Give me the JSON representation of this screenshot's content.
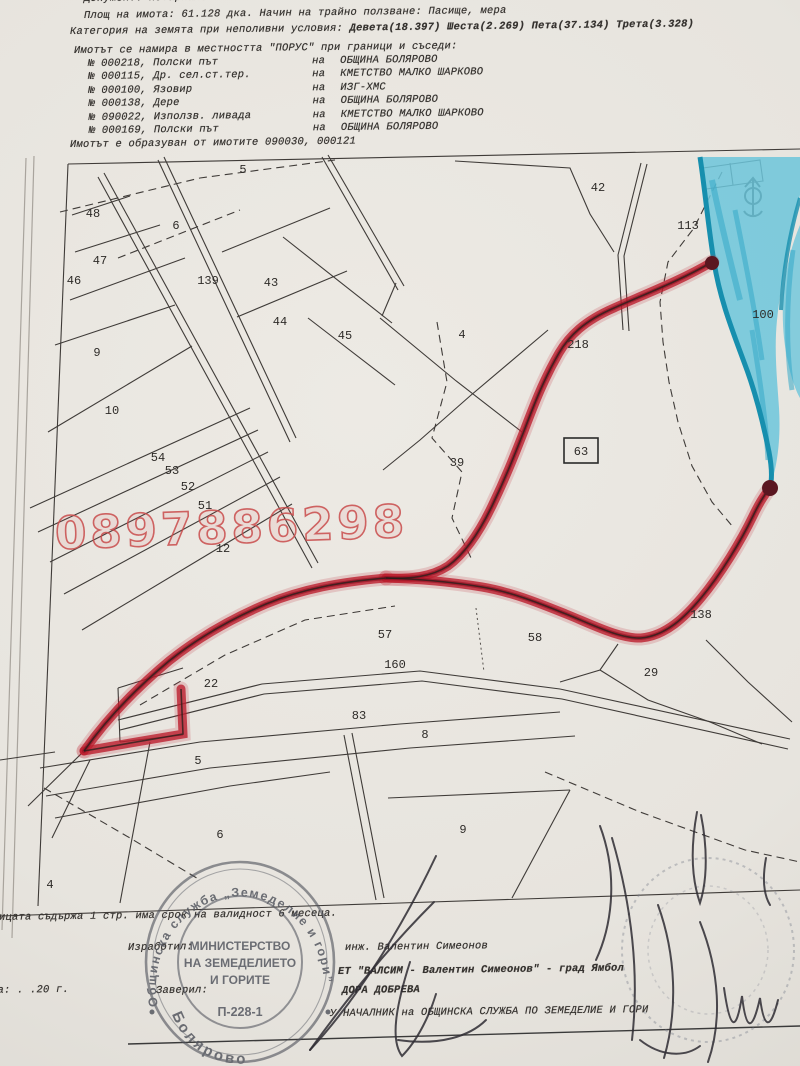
{
  "document": {
    "header": {
      "line0": "Документ: нотариален акт № 33 от 28.03.2000 г. том I рег. 2022 дело 313",
      "line1": "Площ на имота: 61.128 дка. Начин на трайно ползване: Пасище, мера",
      "line2a": "Категория на земята при неполивни условия:",
      "line2b": "Девета(18.397) Шеста(2.269) Пета(37.134) Трета(3.328)",
      "line3": "Имотът се намира в местността \"ПОРУС\" при граници и съседи:",
      "formed": "Имотът е образуван от имотите 090030, 000121"
    },
    "neighbors": [
      {
        "parcel": "№ 000218, Полски път",
        "na": "на",
        "owner": "ОБЩИНА БОЛЯРОВО"
      },
      {
        "parcel": "№ 000115, Др. сел.ст.тер.",
        "na": "на",
        "owner": "КМЕТСТВО МАЛКО ШАРКОВО"
      },
      {
        "parcel": "№ 000100, Язовир",
        "na": "на",
        "owner": "ИЗГ-ХМС"
      },
      {
        "parcel": "№ 000138, Дере",
        "na": "на",
        "owner": "ОБЩИНА БОЛЯРОВО"
      },
      {
        "parcel": "№ 090022, Използв. ливада",
        "na": "на",
        "owner": "КМЕТСТВО МАЛКО ШАРКОВО"
      },
      {
        "parcel": "№ 000169, Полски път",
        "na": "на",
        "owner": "ОБЩИНА БОЛЯРОВО"
      }
    ],
    "footer": {
      "validity": "Скицата съдържа 1 стр.     има срок на валидност 6 месеца.",
      "made_label": "Изработил:",
      "made_by": "инж. Валентин Симеонов",
      "company": "ЕТ \"ВАЛСИМ - Валентин Симеонов\" - град Ямбол",
      "date_line": "Дата:   .    .20  г.",
      "verified_label": "Заверил:",
      "verified_by": "ДОРА ДОБРЕВА",
      "position": "У НАЧАЛНИК на ОБЩИНСКА СЛУЖБА ПО ЗЕМЕДЕЛИЕ И ГОРИ"
    },
    "stamp": {
      "ring_top": "Общинска служба „Земеделие и гори”",
      "ring_bottom": "Болярово",
      "inner1": "МИНИСТЕРСТВО",
      "inner2": "НА ЗЕМЕДЕЛИЕТО",
      "inner3": "И ГОРИТЕ",
      "code": "П-228-1"
    },
    "watermark": "0897886298"
  },
  "map": {
    "subject_parcel": "63",
    "labels": [
      {
        "t": "48",
        "x": 93,
        "y": 217
      },
      {
        "t": "47",
        "x": 100,
        "y": 264
      },
      {
        "t": "46",
        "x": 74,
        "y": 284
      },
      {
        "t": "9",
        "x": 97,
        "y": 356
      },
      {
        "t": "10",
        "x": 112,
        "y": 414
      },
      {
        "t": "6",
        "x": 176,
        "y": 229
      },
      {
        "t": "5",
        "x": 243,
        "y": 173
      },
      {
        "t": "139",
        "x": 208,
        "y": 284
      },
      {
        "t": "43",
        "x": 271,
        "y": 286
      },
      {
        "t": "44",
        "x": 280,
        "y": 325
      },
      {
        "t": "45",
        "x": 345,
        "y": 339
      },
      {
        "t": "42",
        "x": 598,
        "y": 191
      },
      {
        "t": "113",
        "x": 688,
        "y": 229
      },
      {
        "t": "100",
        "x": 763,
        "y": 318
      },
      {
        "t": "218",
        "x": 578,
        "y": 348
      },
      {
        "t": "4",
        "x": 462,
        "y": 338
      },
      {
        "t": "39",
        "x": 457,
        "y": 466
      },
      {
        "t": "12",
        "x": 223,
        "y": 552
      },
      {
        "t": "54",
        "x": 158,
        "y": 461
      },
      {
        "t": "53",
        "x": 172,
        "y": 474
      },
      {
        "t": "52",
        "x": 188,
        "y": 490
      },
      {
        "t": "51",
        "x": 205,
        "y": 509
      },
      {
        "t": "63",
        "x": 581,
        "y": 455
      },
      {
        "t": "57",
        "x": 385,
        "y": 638
      },
      {
        "t": "58",
        "x": 535,
        "y": 641
      },
      {
        "t": "160",
        "x": 395,
        "y": 668
      },
      {
        "t": "22",
        "x": 211,
        "y": 687
      },
      {
        "t": "83",
        "x": 359,
        "y": 719
      },
      {
        "t": "8",
        "x": 425,
        "y": 738
      },
      {
        "t": "5",
        "x": 198,
        "y": 764
      },
      {
        "t": "29",
        "x": 651,
        "y": 676
      },
      {
        "t": "138",
        "x": 701,
        "y": 618
      },
      {
        "t": "9",
        "x": 463,
        "y": 833
      },
      {
        "t": "6",
        "x": 220,
        "y": 838
      },
      {
        "t": "4",
        "x": 50,
        "y": 888
      }
    ],
    "colors": {
      "route_red": "#bc1f2e",
      "water_blue": "#6cc6db",
      "watermark_red": "#c94b4b",
      "ink": "#3f3b38",
      "stamp_ink": "#50535c",
      "paper": "#e8e5df"
    }
  }
}
